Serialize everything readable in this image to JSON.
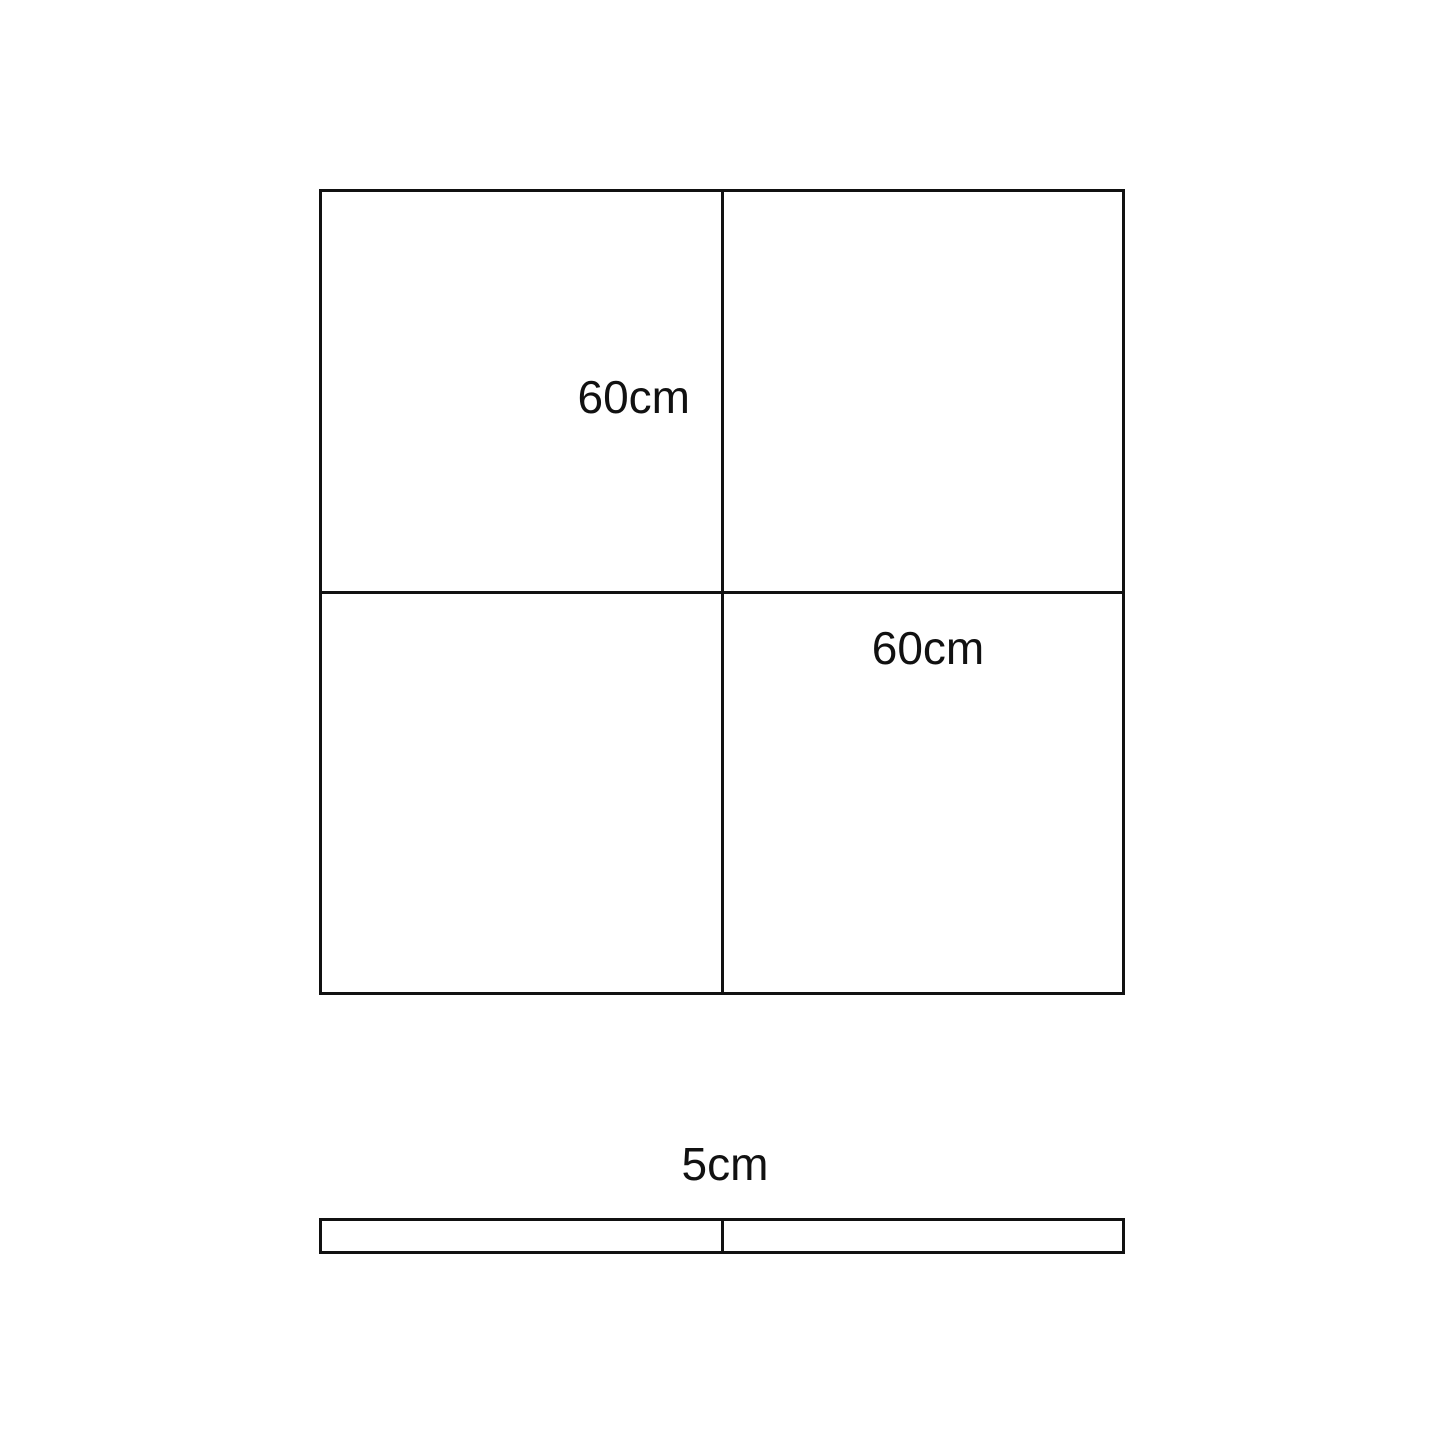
{
  "colors": {
    "background": "#ffffff",
    "line": "#111111"
  },
  "front_view": {
    "labels": [
      "60cm",
      "60cm"
    ]
  },
  "side_view": {
    "label": "5cm"
  }
}
